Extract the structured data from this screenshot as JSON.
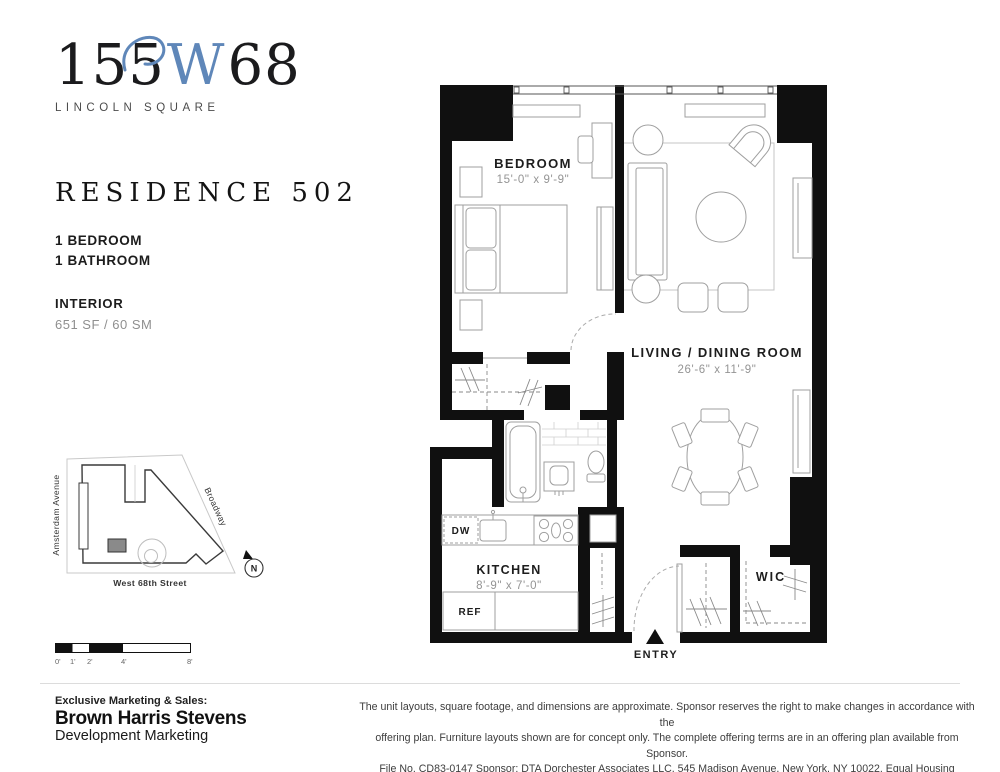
{
  "logo": {
    "number_prefix": "155",
    "letter": "W",
    "number_suffix": "68",
    "tagline": "LINCOLN SQUARE",
    "accent_color": "#5f87b9"
  },
  "residence": {
    "title": "RESIDENCE 502",
    "spec_lines": [
      "1 BEDROOM",
      "1 BATHROOM"
    ],
    "interior_label": "INTERIOR",
    "interior_area": "651 SF / 60 SM"
  },
  "site_map": {
    "street_left": "Amsterdam Avenue",
    "street_right": "Broadway",
    "street_bottom": "West 68th Street",
    "compass_label": "N",
    "unit_marker_color": "#8a8a8a"
  },
  "scale_bar": {
    "tick_labels": [
      "0'",
      "1'",
      "2'",
      "4'",
      "8'"
    ]
  },
  "floor_plan": {
    "bedroom": {
      "name": "BEDROOM",
      "dims": "15'-0\" x 9'-9\""
    },
    "living": {
      "name": "LIVING / DINING ROOM",
      "dims": "26'-6\" x 11'-9\""
    },
    "kitchen": {
      "name": "KITCHEN",
      "dims": "8'-9\" x 7'-0\""
    },
    "wic_label": "WIC",
    "dw_label": "DW",
    "ref_label": "REF",
    "entry_label": "ENTRY",
    "wall_color": "#101010"
  },
  "footer": {
    "sales_label": "Exclusive Marketing & Sales:",
    "company": "Brown Harris Stevens",
    "division": "Development Marketing",
    "disclaimer_lines": [
      "The unit layouts, square footage, and dimensions are approximate. Sponsor reserves the right to make changes in accordance with the",
      "offering plan. Furniture layouts shown are for concept only. The complete offering terms are in an offering plan available from Sponsor.",
      "File No. CD83-0147 Sponsor: DTA Dorchester Associates LLC, 545 Madison Avenue, New York, NY 10022. Equal Housing Opportunity."
    ]
  }
}
